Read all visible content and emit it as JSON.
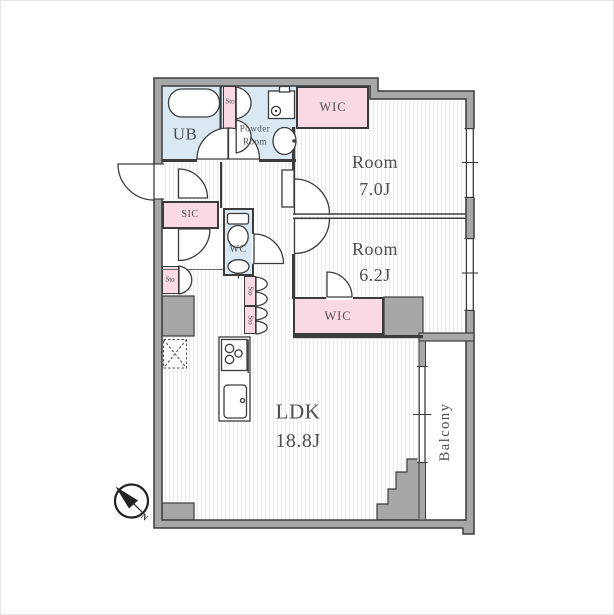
{
  "title": "apartment-floor-plan",
  "theme": {
    "wall": "#a7a7a7",
    "wall_edge": "#3c3c3c",
    "water_area": "#d9e8f2",
    "closet_area": "#f8d9e4",
    "floor_stripe": "#eaeaea",
    "label_text": "#4f4f4f"
  },
  "rooms": {
    "ub": {
      "label": "UB"
    },
    "powder": {
      "line1": "Powder",
      "line2": "Room"
    },
    "wic_upper": {
      "label": "WIC"
    },
    "bedroom1": {
      "name": "Room",
      "size": "7.0J"
    },
    "bedroom2": {
      "name": "Room",
      "size": "6.2J"
    },
    "wic_lower": {
      "label": "WIC"
    },
    "sic": {
      "label": "SIC"
    },
    "wc": {
      "label": "WC"
    },
    "ldk": {
      "name": "LDK",
      "size": "18.8J"
    },
    "balcony": {
      "label": "Balcony"
    }
  },
  "storage": {
    "sto_bath": "Sto",
    "sto_entry": "Sto",
    "sto_hall_upper": "Sto",
    "sto_hall_lower": "Sto"
  },
  "compass": {
    "north": "N"
  }
}
